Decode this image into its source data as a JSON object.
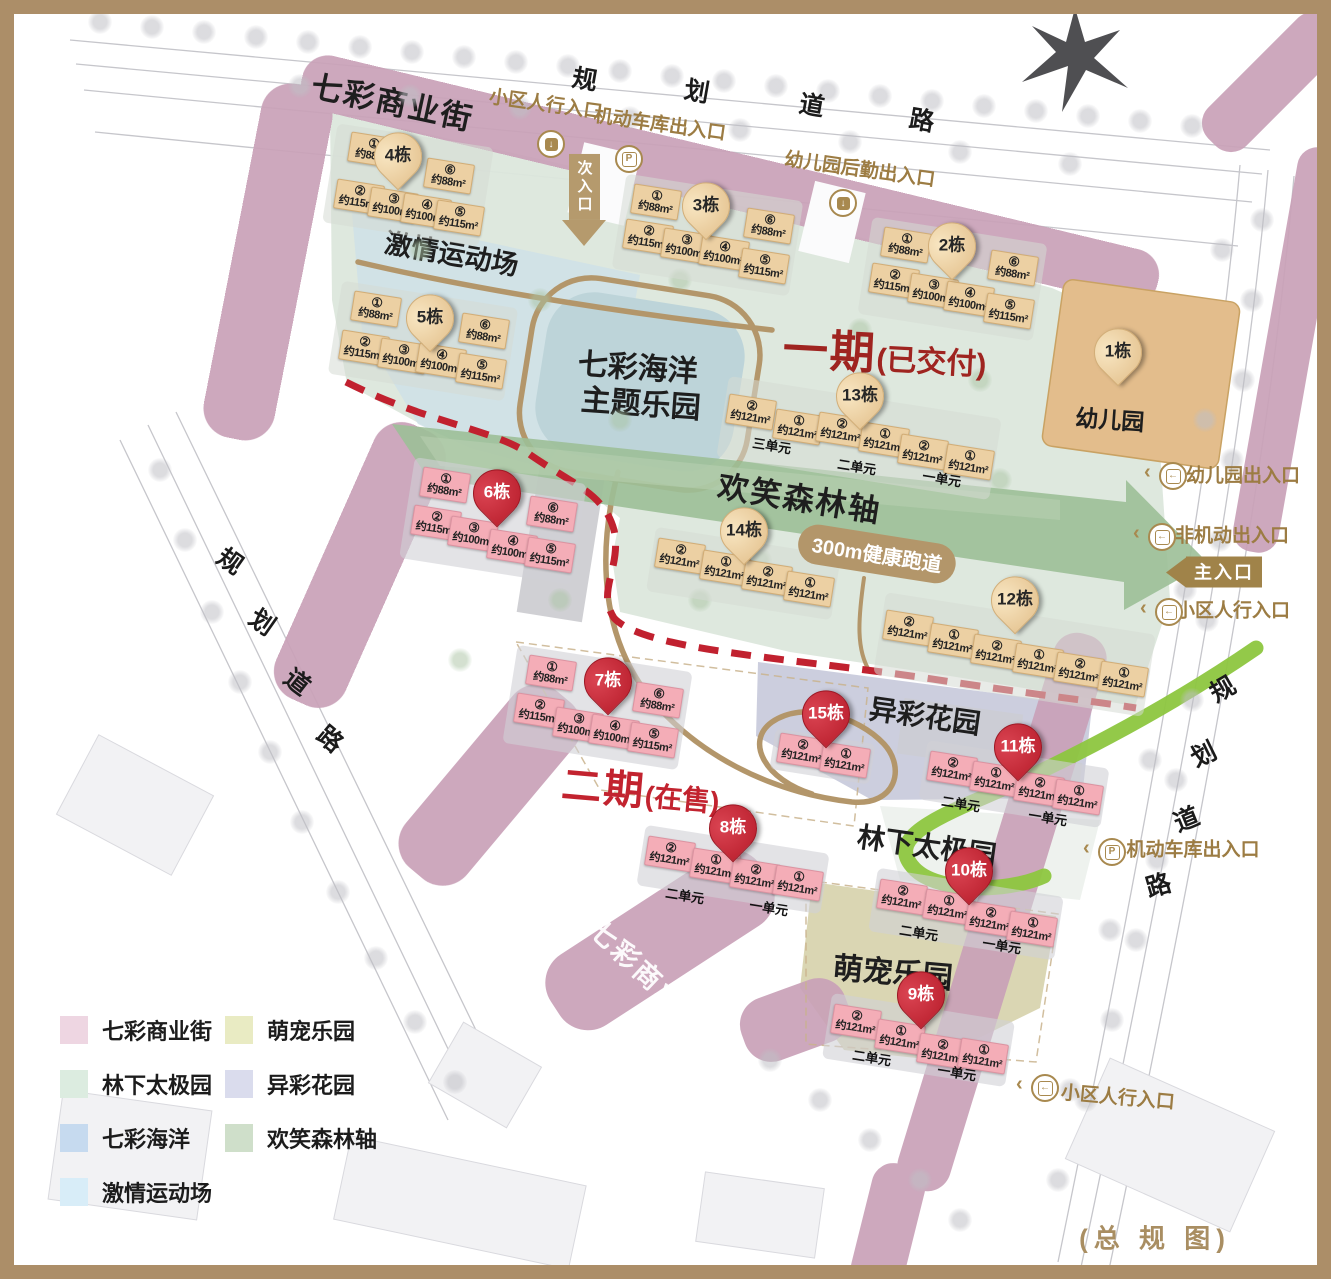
{
  "title": "总规图",
  "colors": {
    "frame": "#ac8e68",
    "phase1_text": "#9f2420",
    "phase2_text": "#c2232f",
    "pin_red": "#c1212f",
    "pin_tan": "#eed2a4",
    "building_tan": "#ecd0a3",
    "building_pink": "#f4adb7",
    "gold_path": "#b3966a",
    "red_dashed_line": "#c1212f",
    "green_line": "#8dc63f",
    "commercial_band": "#c9a1b8",
    "forest_axis": "#9cbf97",
    "ocean_pool": "#bdd4d9",
    "sports_field": "#cfe1e7",
    "phase1_area": "#dce7dc",
    "garden_area": "#c7c9da",
    "pet_area": "#d7d3ad",
    "entrance_text": "#9c7c43"
  },
  "labels": {
    "commercial_top": "七彩商业街",
    "commercial_bottom": "七彩商业街",
    "sports": "激情运动场",
    "ocean_line1": "七彩海洋",
    "ocean_line2": "主题乐园",
    "forest": "欢笑森林轴",
    "track": "300m健康跑道",
    "garden": "异彩花园",
    "taichi": "林下太极园",
    "pet": "萌宠乐园",
    "kindergarten": "幼儿园",
    "phase1": "一期",
    "phase1_sub": "(已交付)",
    "phase2": "二期",
    "phase2_sub": "(在售)",
    "overview": "(总 规 图)"
  },
  "roads": {
    "top": {
      "text": "规划道路",
      "chars": [
        {
          "c": "规",
          "x": 585,
          "y": 78,
          "rot": 10
        },
        {
          "c": "划",
          "x": 697,
          "y": 90,
          "rot": 10
        },
        {
          "c": "道",
          "x": 812,
          "y": 104,
          "rot": 10
        },
        {
          "c": "路",
          "x": 922,
          "y": 119,
          "rot": 10
        }
      ]
    },
    "left": {
      "text": "规划道路",
      "chars": [
        {
          "c": "规",
          "x": 231,
          "y": 560,
          "rot": 35
        },
        {
          "c": "划",
          "x": 263,
          "y": 621,
          "rot": 35
        },
        {
          "c": "道",
          "x": 298,
          "y": 681,
          "rot": 38
        },
        {
          "c": "路",
          "x": 331,
          "y": 738,
          "rot": 40
        }
      ]
    },
    "right": {
      "text": "规划道路",
      "chars": [
        {
          "c": "规",
          "x": 1222,
          "y": 688,
          "rot": -30
        },
        {
          "c": "划",
          "x": 1203,
          "y": 753,
          "rot": -26
        },
        {
          "c": "道",
          "x": 1186,
          "y": 818,
          "rot": -22
        },
        {
          "c": "路",
          "x": 1158,
          "y": 884,
          "rot": -16
        }
      ]
    }
  },
  "entrances": [
    {
      "type": "door",
      "icon": "ped",
      "chev": false,
      "text": "小区人行入口",
      "tx": 546,
      "ty": 103,
      "rot": 8,
      "ix": 549,
      "iy": 142
    },
    {
      "type": "door",
      "icon": "park",
      "chev": false,
      "text": "机动车库出入口",
      "tx": 660,
      "ty": 123,
      "rot": 8,
      "ix": 627,
      "iy": 157
    },
    {
      "type": "door",
      "icon": "ped",
      "chev": false,
      "text": "幼儿园后勤出入口",
      "tx": 860,
      "ty": 168,
      "rot": 8,
      "ix": 841,
      "iy": 201
    },
    {
      "type": "door",
      "icon": "in",
      "chev": true,
      "text": "幼儿园出入口",
      "tx": 1243,
      "ty": 474,
      "rot": 0,
      "ix": 1171,
      "iy": 474
    },
    {
      "type": "door",
      "icon": "in",
      "chev": true,
      "text": "非机动出入口",
      "tx": 1232,
      "ty": 534,
      "rot": 0,
      "ix": 1160,
      "iy": 535
    },
    {
      "type": "main",
      "text": "主入口",
      "tx": 1214,
      "ty": 572
    },
    {
      "type": "door",
      "icon": "in",
      "chev": true,
      "text": "小区人行入口",
      "tx": 1233,
      "ty": 609,
      "rot": 0,
      "ix": 1167,
      "iy": 610
    },
    {
      "type": "door",
      "icon": "park",
      "chev": true,
      "text": "机动车库出入口",
      "tx": 1193,
      "ty": 848,
      "rot": 0,
      "ix": 1110,
      "iy": 850
    },
    {
      "type": "door",
      "icon": "in",
      "chev": true,
      "text": "小区人行入口",
      "tx": 1118,
      "ty": 1096,
      "rot": 5,
      "ix": 1043,
      "iy": 1086
    },
    {
      "type": "sub",
      "text": "次入口",
      "tx": 584,
      "ty": 165
    }
  ],
  "buildings": [
    {
      "name": "1栋",
      "phase": 1,
      "pin": {
        "x": 1118,
        "y": 362
      },
      "units": [],
      "unit_labels": []
    },
    {
      "name": "4栋",
      "phase": 1,
      "pin": {
        "x": 398,
        "y": 166
      },
      "units": [
        {
          "n": "①",
          "a": "约88m²",
          "x": 372,
          "y": 150
        },
        {
          "n": "⑥",
          "a": "约88m²",
          "x": 448,
          "y": 176
        },
        {
          "n": "②",
          "a": "约115m²",
          "x": 358,
          "y": 197
        },
        {
          "n": "③",
          "a": "约100m²",
          "x": 392,
          "y": 205
        },
        {
          "n": "④",
          "a": "约100m²",
          "x": 425,
          "y": 211
        },
        {
          "n": "⑤",
          "a": "约115m²",
          "x": 458,
          "y": 218
        }
      ],
      "unit_labels": []
    },
    {
      "name": "3栋",
      "phase": 1,
      "pin": {
        "x": 706,
        "y": 216
      },
      "units": [
        {
          "n": "①",
          "a": "约88m²",
          "x": 655,
          "y": 202
        },
        {
          "n": "⑥",
          "a": "约88m²",
          "x": 768,
          "y": 226
        },
        {
          "n": "②",
          "a": "约115m²",
          "x": 647,
          "y": 237
        },
        {
          "n": "③",
          "a": "约100m²",
          "x": 685,
          "y": 246
        },
        {
          "n": "④",
          "a": "约100m²",
          "x": 723,
          "y": 253
        },
        {
          "n": "⑤",
          "a": "约115m²",
          "x": 763,
          "y": 266
        }
      ],
      "unit_labels": []
    },
    {
      "name": "2栋",
      "phase": 1,
      "pin": {
        "x": 952,
        "y": 256
      },
      "units": [
        {
          "n": "①",
          "a": "约88m²",
          "x": 905,
          "y": 245
        },
        {
          "n": "⑥",
          "a": "约88m²",
          "x": 1012,
          "y": 268
        },
        {
          "n": "②",
          "a": "约115m²",
          "x": 893,
          "y": 281
        },
        {
          "n": "③",
          "a": "约100m²",
          "x": 932,
          "y": 291
        },
        {
          "n": "④",
          "a": "约100m²",
          "x": 968,
          "y": 299
        },
        {
          "n": "⑤",
          "a": "约115m²",
          "x": 1008,
          "y": 311
        }
      ],
      "unit_labels": []
    },
    {
      "name": "5栋",
      "phase": 1,
      "pin": {
        "x": 430,
        "y": 328
      },
      "units": [
        {
          "n": "①",
          "a": "约88m²",
          "x": 375,
          "y": 309
        },
        {
          "n": "⑥",
          "a": "约88m²",
          "x": 483,
          "y": 331
        },
        {
          "n": "②",
          "a": "约115m²",
          "x": 363,
          "y": 348
        },
        {
          "n": "③",
          "a": "约100m²",
          "x": 402,
          "y": 356
        },
        {
          "n": "④",
          "a": "约100m²",
          "x": 440,
          "y": 361
        },
        {
          "n": "⑤",
          "a": "约115m²",
          "x": 480,
          "y": 371
        }
      ],
      "unit_labels": []
    },
    {
      "name": "13栋",
      "phase": 1,
      "pin": {
        "x": 860,
        "y": 406
      },
      "units": [
        {
          "n": "②",
          "a": "约121m²",
          "x": 750,
          "y": 412
        },
        {
          "n": "①",
          "a": "约121m²",
          "x": 797,
          "y": 427
        },
        {
          "n": "②",
          "a": "约121m²",
          "x": 840,
          "y": 430
        },
        {
          "n": "①",
          "a": "约121m²",
          "x": 883,
          "y": 440
        },
        {
          "n": "②",
          "a": "约121m²",
          "x": 922,
          "y": 452
        },
        {
          "n": "①",
          "a": "约121m²",
          "x": 968,
          "y": 462
        }
      ],
      "unit_labels": [
        {
          "t": "三单元",
          "x": 772,
          "y": 445
        },
        {
          "t": "二单元",
          "x": 857,
          "y": 466
        },
        {
          "t": "一单元",
          "x": 942,
          "y": 478
        }
      ]
    },
    {
      "name": "14栋",
      "phase": 1,
      "pin": {
        "x": 744,
        "y": 541
      },
      "units": [
        {
          "n": "②",
          "a": "约121m²",
          "x": 679,
          "y": 556
        },
        {
          "n": "①",
          "a": "约121m²",
          "x": 724,
          "y": 568
        },
        {
          "n": "②",
          "a": "约121m²",
          "x": 766,
          "y": 578
        },
        {
          "n": "①",
          "a": "约121m²",
          "x": 808,
          "y": 589
        }
      ],
      "unit_labels": []
    },
    {
      "name": "12栋",
      "phase": 1,
      "pin": {
        "x": 1015,
        "y": 610
      },
      "units": [
        {
          "n": "②",
          "a": "约121m²",
          "x": 907,
          "y": 628
        },
        {
          "n": "①",
          "a": "约121m²",
          "x": 952,
          "y": 641
        },
        {
          "n": "②",
          "a": "约121m²",
          "x": 995,
          "y": 652
        },
        {
          "n": "①",
          "a": "约121m²",
          "x": 1037,
          "y": 661
        },
        {
          "n": "②",
          "a": "约121m²",
          "x": 1078,
          "y": 670
        },
        {
          "n": "①",
          "a": "约121m²",
          "x": 1122,
          "y": 679
        }
      ],
      "unit_labels": []
    },
    {
      "name": "6栋",
      "phase": 2,
      "pin": {
        "x": 497,
        "y": 503
      },
      "units": [
        {
          "n": "①",
          "a": "约88m²",
          "x": 444,
          "y": 485
        },
        {
          "n": "⑥",
          "a": "约88m²",
          "x": 551,
          "y": 514
        },
        {
          "n": "②",
          "a": "约115m²",
          "x": 435,
          "y": 523
        },
        {
          "n": "③",
          "a": "约100m²",
          "x": 472,
          "y": 534
        },
        {
          "n": "④",
          "a": "约100m²",
          "x": 511,
          "y": 547
        },
        {
          "n": "⑤",
          "a": "约115m²",
          "x": 549,
          "y": 555
        }
      ],
      "unit_labels": []
    },
    {
      "name": "7栋",
      "phase": 2,
      "pin": {
        "x": 608,
        "y": 691
      },
      "units": [
        {
          "n": "①",
          "a": "约88m²",
          "x": 550,
          "y": 673
        },
        {
          "n": "⑥",
          "a": "约88m²",
          "x": 657,
          "y": 700
        },
        {
          "n": "②",
          "a": "约115m²",
          "x": 538,
          "y": 711
        },
        {
          "n": "③",
          "a": "约100m²",
          "x": 577,
          "y": 725
        },
        {
          "n": "④",
          "a": "约100m²",
          "x": 613,
          "y": 732
        },
        {
          "n": "⑤",
          "a": "约115m²",
          "x": 652,
          "y": 740
        }
      ],
      "unit_labels": []
    },
    {
      "name": "15栋",
      "phase": 2,
      "pin": {
        "x": 826,
        "y": 724
      },
      "units": [
        {
          "n": "②",
          "a": "约121m²",
          "x": 801,
          "y": 751
        },
        {
          "n": "①",
          "a": "约121m²",
          "x": 844,
          "y": 760
        }
      ],
      "unit_labels": []
    },
    {
      "name": "11栋",
      "phase": 2,
      "pin": {
        "x": 1018,
        "y": 757
      },
      "units": [
        {
          "n": "②",
          "a": "约121m²",
          "x": 951,
          "y": 769
        },
        {
          "n": "①",
          "a": "约121m²",
          "x": 994,
          "y": 779
        },
        {
          "n": "②",
          "a": "约121m²",
          "x": 1038,
          "y": 789
        },
        {
          "n": "①",
          "a": "约121m²",
          "x": 1077,
          "y": 797
        }
      ],
      "unit_labels": [
        {
          "t": "二单元",
          "x": 961,
          "y": 803
        },
        {
          "t": "一单元",
          "x": 1048,
          "y": 817
        }
      ]
    },
    {
      "name": "8栋",
      "phase": 2,
      "pin": {
        "x": 733,
        "y": 838
      },
      "units": [
        {
          "n": "②",
          "a": "约121m²",
          "x": 669,
          "y": 854
        },
        {
          "n": "①",
          "a": "约121m²",
          "x": 714,
          "y": 866
        },
        {
          "n": "②",
          "a": "约121m²",
          "x": 754,
          "y": 876
        },
        {
          "n": "①",
          "a": "约121m²",
          "x": 797,
          "y": 883
        }
      ],
      "unit_labels": [
        {
          "t": "二单元",
          "x": 685,
          "y": 895
        },
        {
          "t": "一单元",
          "x": 769,
          "y": 907
        }
      ]
    },
    {
      "name": "10栋",
      "phase": 2,
      "pin": {
        "x": 969,
        "y": 881
      },
      "units": [
        {
          "n": "②",
          "a": "约121m²",
          "x": 901,
          "y": 897
        },
        {
          "n": "①",
          "a": "约121m²",
          "x": 947,
          "y": 907
        },
        {
          "n": "②",
          "a": "约121m²",
          "x": 989,
          "y": 919
        },
        {
          "n": "①",
          "a": "约121m²",
          "x": 1031,
          "y": 929
        }
      ],
      "unit_labels": [
        {
          "t": "二单元",
          "x": 919,
          "y": 932
        },
        {
          "t": "一单元",
          "x": 1002,
          "y": 945
        }
      ]
    },
    {
      "name": "9栋",
      "phase": 2,
      "pin": {
        "x": 921,
        "y": 1005
      },
      "units": [
        {
          "n": "②",
          "a": "约121m²",
          "x": 855,
          "y": 1022
        },
        {
          "n": "①",
          "a": "约121m²",
          "x": 899,
          "y": 1037
        },
        {
          "n": "②",
          "a": "约121m²",
          "x": 941,
          "y": 1051
        },
        {
          "n": "①",
          "a": "约121m²",
          "x": 982,
          "y": 1056
        }
      ],
      "unit_labels": [
        {
          "t": "二单元",
          "x": 872,
          "y": 1057
        },
        {
          "t": "一单元",
          "x": 957,
          "y": 1072
        }
      ]
    }
  ],
  "legend": {
    "col1": [
      {
        "label": "七彩商业街",
        "color": "#eed6e2"
      },
      {
        "label": "林下太极园",
        "color": "#dcece0"
      },
      {
        "label": "七彩海洋",
        "color": "#c6daef"
      },
      {
        "label": "激情运动场",
        "color": "#d8edf8"
      }
    ],
    "col2": [
      {
        "label": "萌宠乐园",
        "color": "#e9ebc3"
      },
      {
        "label": "异彩花园",
        "color": "#dadced"
      },
      {
        "label": "欢笑森林轴",
        "color": "#cfdfca"
      }
    ]
  }
}
